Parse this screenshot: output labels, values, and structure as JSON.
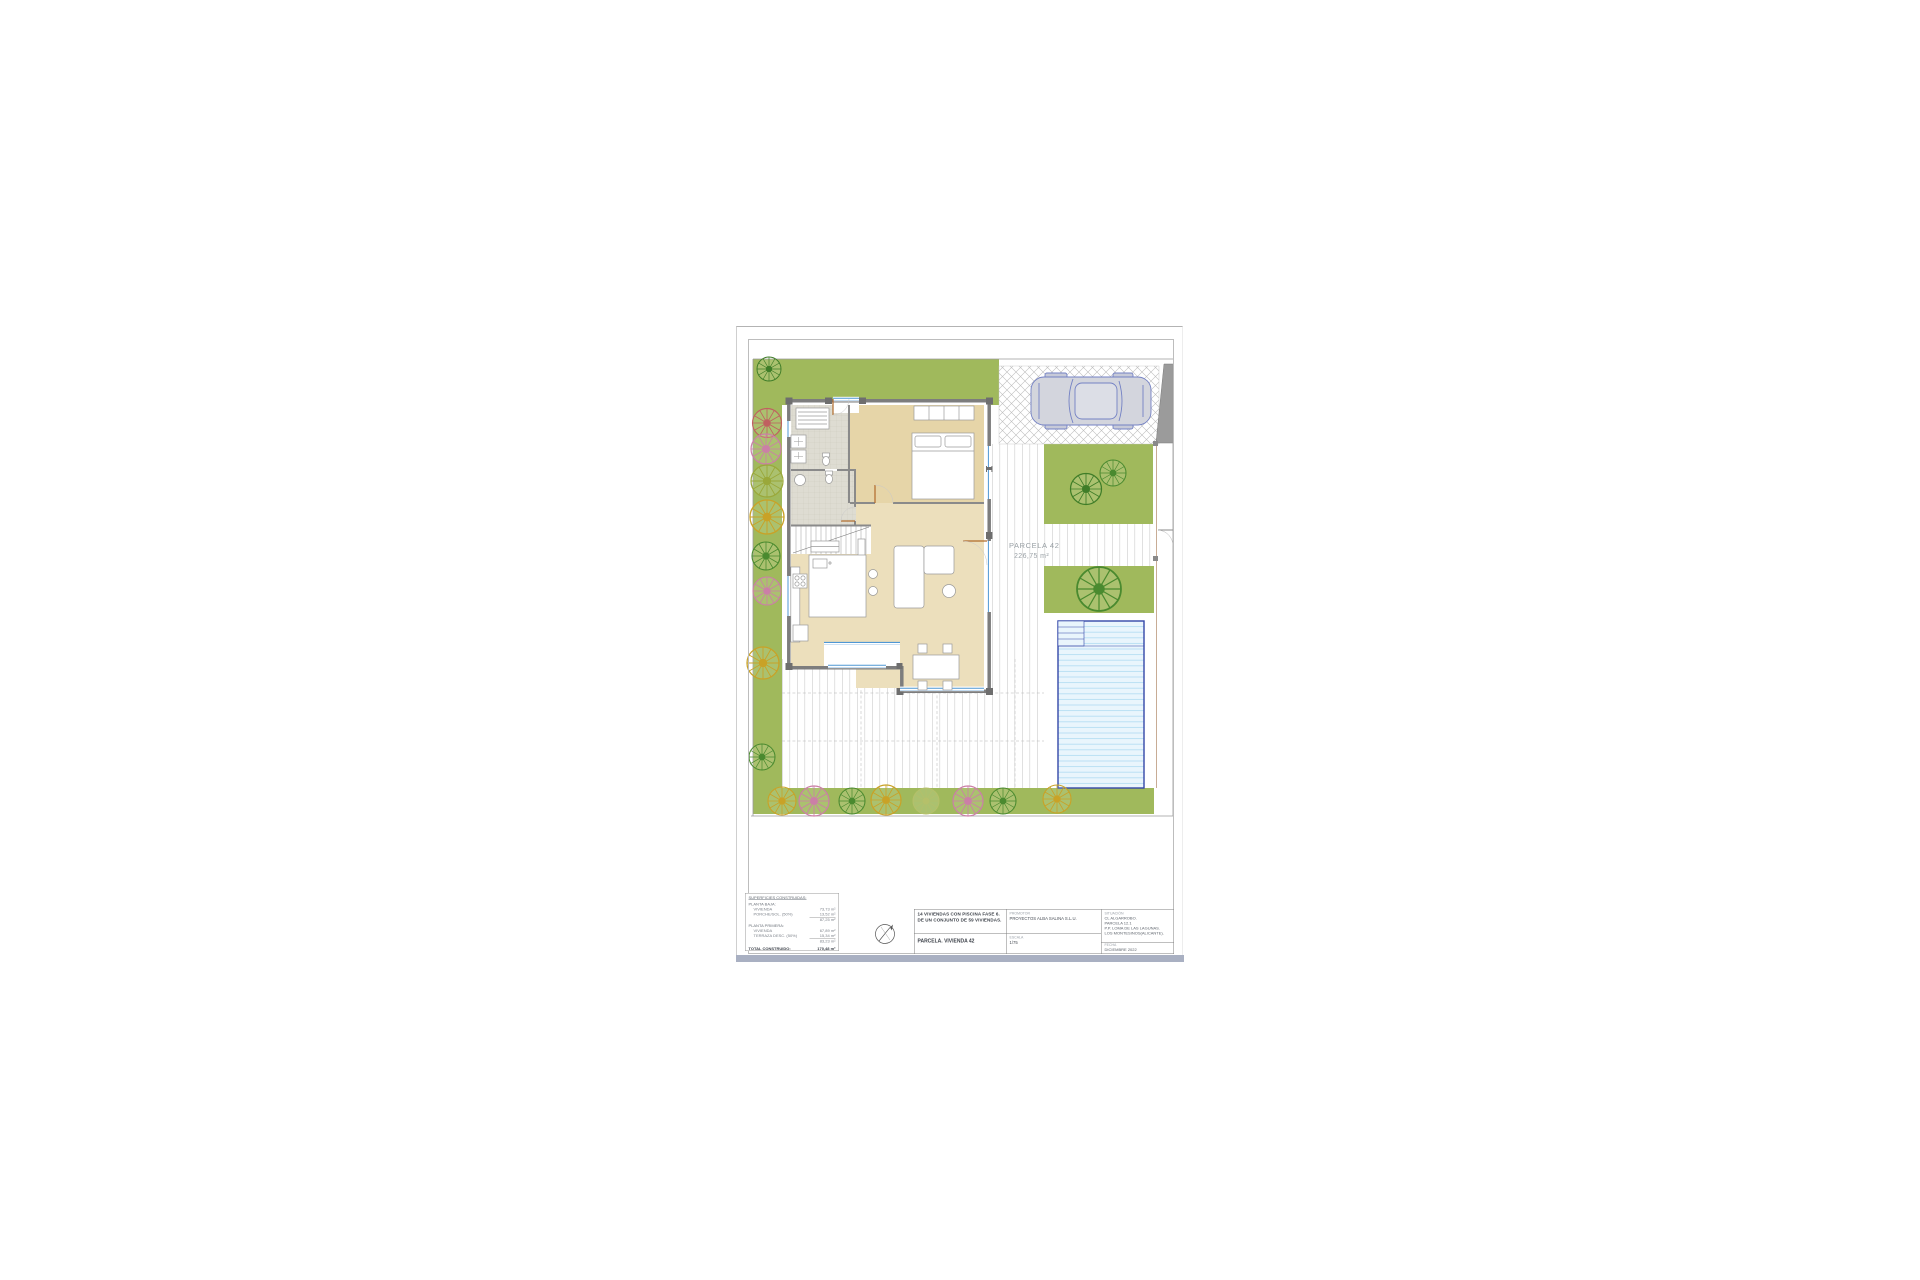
{
  "sheet": {
    "page": {
      "parcel_label": "PARCELA 42",
      "parcel_area": "226,75 m²"
    },
    "stats": {
      "header": "SUPERFICIES CONSTRUIDAS:",
      "g1_title": "PLANTA BAJA:",
      "g1_r1_label": "VIVIENDA",
      "g1_r1_value": "73,73 m²",
      "g1_r2_label": "PORCHE/SOL. (50%)",
      "g1_r2_value": "13,52 m²",
      "g1_subtotal": "87,25 m²",
      "g2_title": "PLANTA PRIMERA:",
      "g2_r1_label": "VIVIENDA",
      "g2_r1_value": "67,89 m²",
      "g2_r2_label": "TERRAZA DESC. (50%)",
      "g2_r2_value": "15,34 m²",
      "g2_subtotal": "83,23 m²",
      "total_label": "TOTAL CONSTRUIDO:",
      "total_value": "170,48 m²"
    },
    "titleblock": {
      "project_line1": "14 VIVIENDAS CON PISCINA FASE 6.",
      "project_line2": "DE UN CONJUNTO DE 59 VIVIENDAS.",
      "drawing_title": "PARCELA. VIVIENDA 42",
      "promoter_label": "PROMOTOR",
      "promoter_value": "PROYECTOS ALBA SALINA S.L.U.",
      "scale_label": "ESCALA",
      "scale_value": "1/75",
      "location_label": "SITUACIÓN",
      "loc1": "CL ALGARROBO.",
      "loc2": "PARCELA 12.1",
      "loc3": "P.P. LOMA DE LAS LAGUNAS.",
      "loc4": "LOS MONTESINOS(ALICANTE).",
      "date_label": "FECHA",
      "date_value": "DICIEMBRE 2022"
    },
    "colors": {
      "garden_green": "#a0b95c",
      "pool_border_blue": "#3347a8",
      "pool_water": "#e9f5fc",
      "floor_tan": "#ecdfbc",
      "window_blue": "#4f97d4",
      "bottom_band": "#a9b0c2"
    }
  }
}
